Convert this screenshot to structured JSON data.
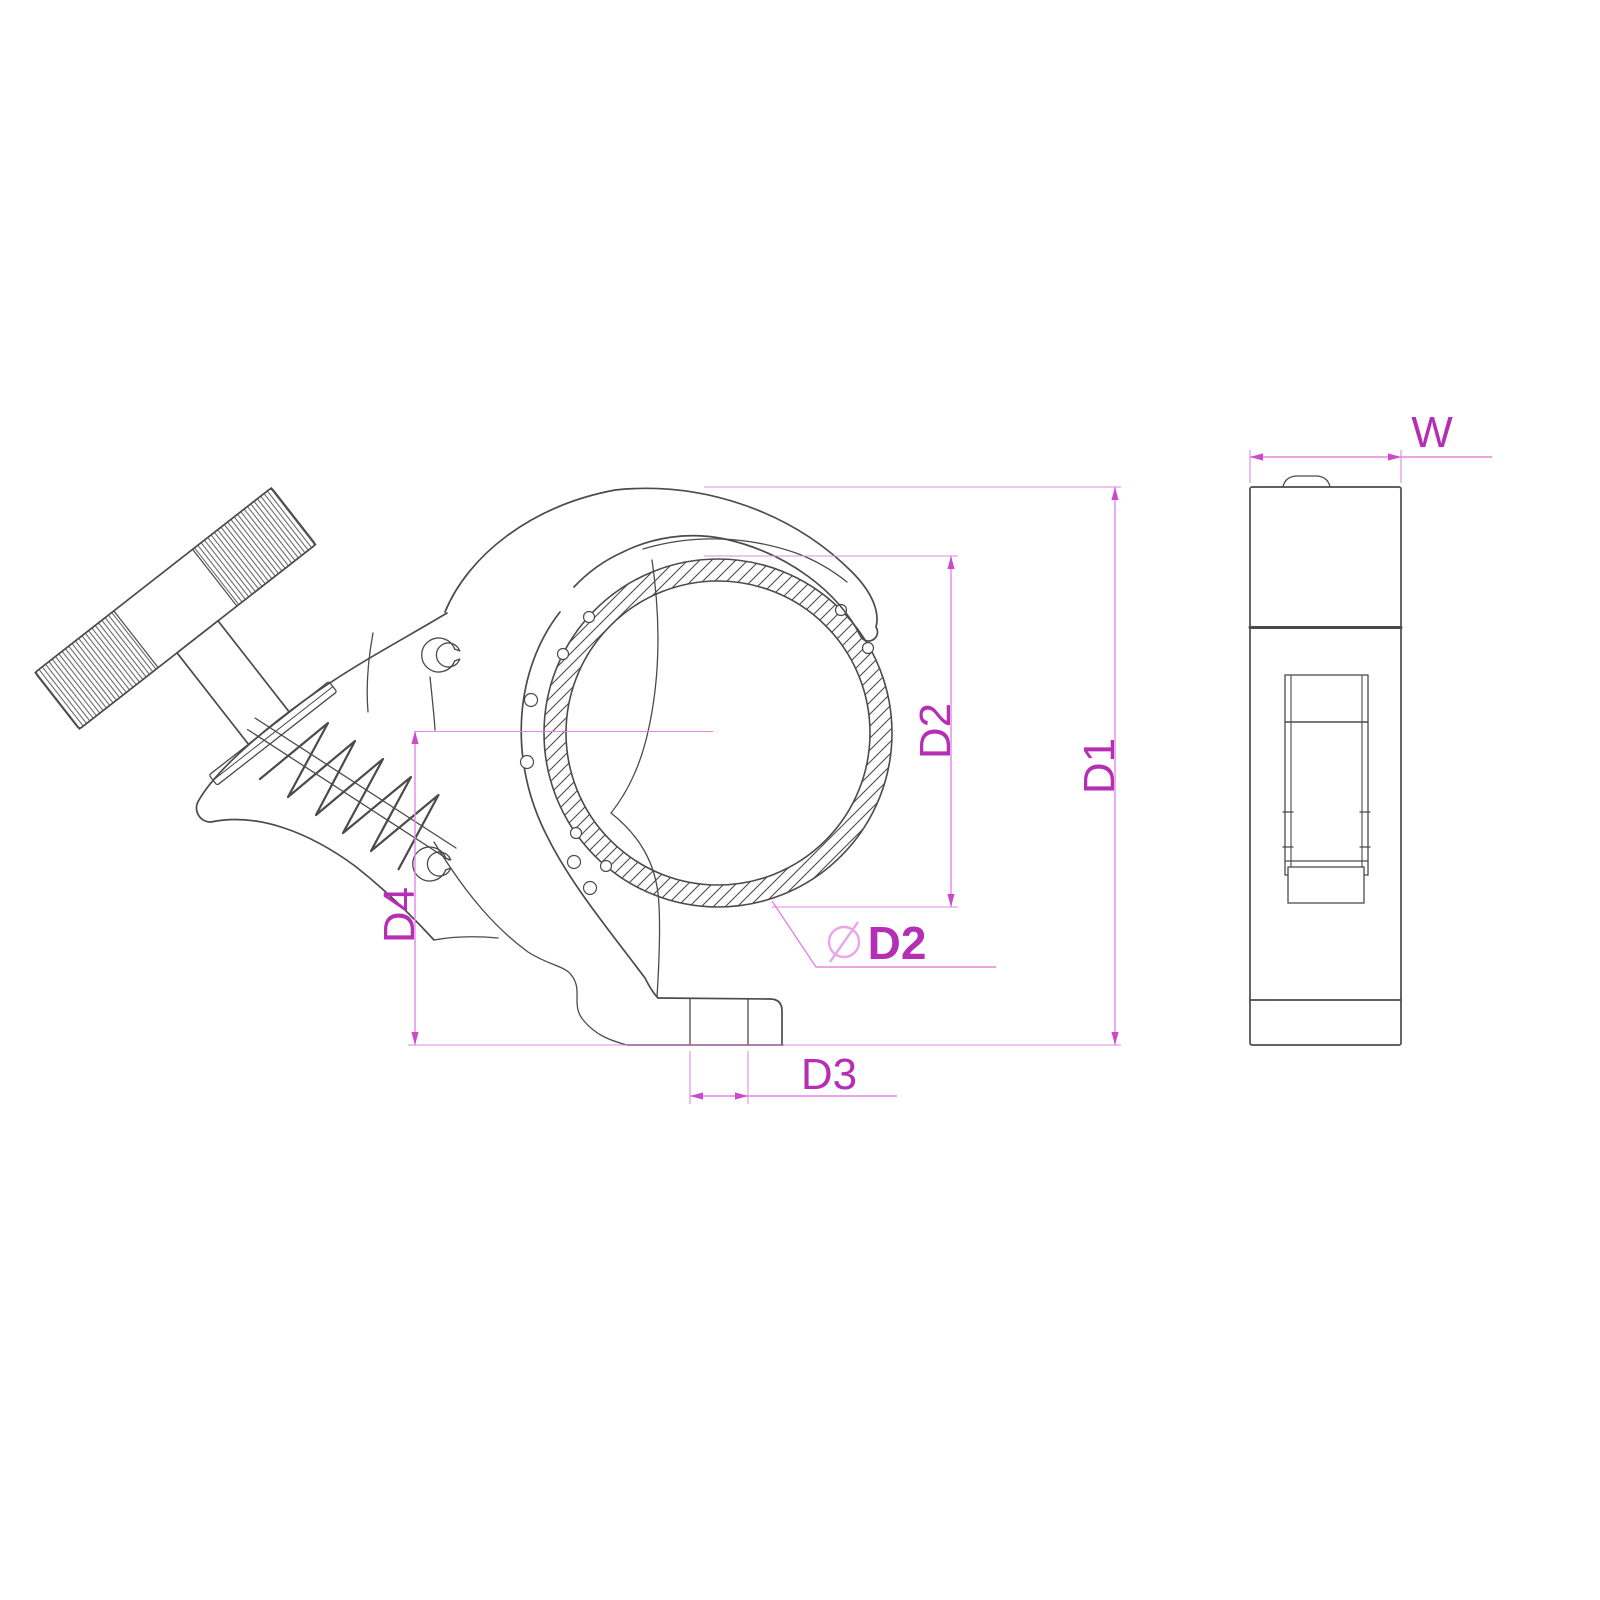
{
  "labels": {
    "w": "W",
    "d1": "D1",
    "d2": "D2",
    "d3": "D3",
    "d4": "D4",
    "diameter_symbol_name": "diameter-symbol",
    "diameter_value": "D2"
  },
  "colors": {
    "background": "#ffffff",
    "drawing_line": "#4b4b4b",
    "dimension_line": "#e387e3",
    "dimension_text": "#b52fb5",
    "arrowhead": "#cb49cb",
    "diameter_symbol_color": "#e9a6e9"
  }
}
